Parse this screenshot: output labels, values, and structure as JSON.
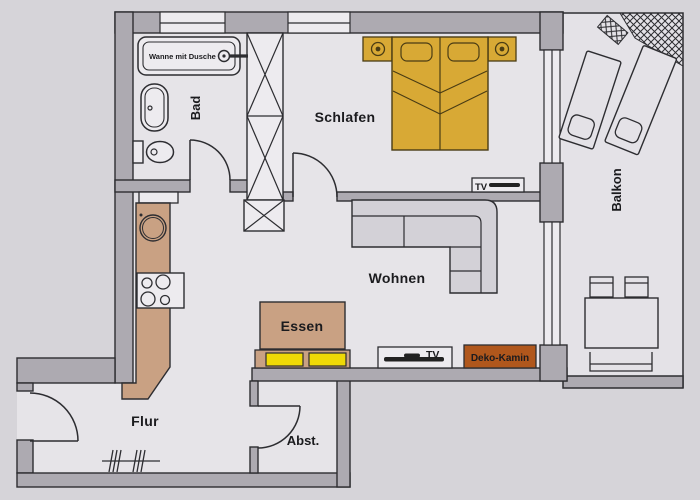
{
  "floorplan": {
    "type": "apartment-floor-plan",
    "rooms": {
      "bad": {
        "label": "Bad"
      },
      "schlafen": {
        "label": "Schlafen"
      },
      "wohnen": {
        "label": "Wohnen"
      },
      "essen": {
        "label": "Essen"
      },
      "flur": {
        "label": "Flur"
      },
      "abstellraum": {
        "label": "Abst."
      },
      "balkon": {
        "label": "Balkon"
      }
    },
    "fixtures": {
      "tub_label": "Wanne mit Dusche",
      "tv_schlafen_label": "TV",
      "tv_wohnen_label": "TV",
      "kamin_label": "Deko-Kamin"
    },
    "colors": {
      "paper": "#d6d4d9",
      "floor": "#e6e4e8",
      "wall": "#adaab1",
      "outline": "#2d2d31",
      "wood": "#c9a183",
      "bed_gold": "#d8a935",
      "chair_yellow": "#efd906",
      "kamin_rust": "#b0571c",
      "sofa_gray": "#d3d1d7",
      "fixture_white": "#edebef"
    }
  }
}
